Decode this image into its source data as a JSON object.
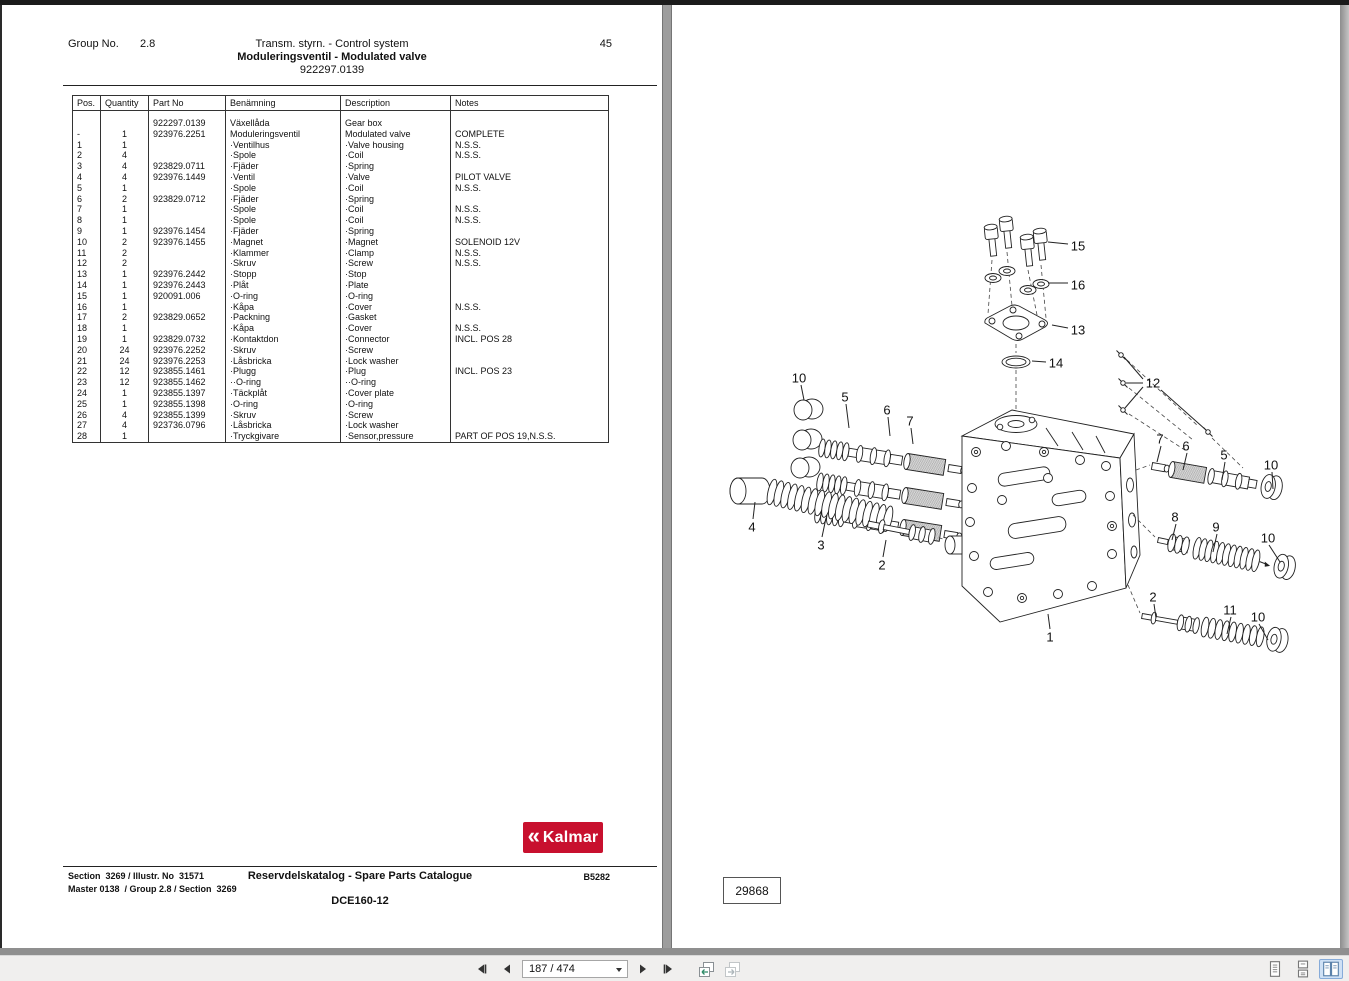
{
  "left_page": {
    "header": {
      "group_label": "Group No.",
      "group_value": "2.8",
      "title1": "Transm. styrn. - Control system",
      "title2": "Moduleringsventil - Modulated valve",
      "part_number": "922297.0139",
      "page_number": "45"
    },
    "table": {
      "columns": [
        "Pos.",
        "Quantity",
        "Part No",
        "Benämning",
        "Description",
        "Notes"
      ],
      "rows": [
        [
          "",
          "",
          "922297.0139",
          "Växellåda",
          "Gear box",
          ""
        ],
        [
          "-",
          "1",
          "923976.2251",
          "Moduleringsventil",
          "Modulated valve",
          "COMPLETE"
        ],
        [
          "1",
          "1",
          "",
          "·Ventilhus",
          "·Valve housing",
          "N.S.S."
        ],
        [
          "2",
          "4",
          "",
          "·Spole",
          "·Coil",
          "N.S.S."
        ],
        [
          "3",
          "4",
          "923829.0711",
          "·Fjäder",
          "·Spring",
          ""
        ],
        [
          "4",
          "4",
          "923976.1449",
          "·Ventil",
          "·Valve",
          "PILOT VALVE"
        ],
        [
          "5",
          "1",
          "",
          "·Spole",
          "·Coil",
          "N.S.S."
        ],
        [
          "6",
          "2",
          "923829.0712",
          "·Fjäder",
          "·Spring",
          ""
        ],
        [
          "7",
          "1",
          "",
          "·Spole",
          "·Coil",
          "N.S.S."
        ],
        [
          "8",
          "1",
          "",
          "·Spole",
          "·Coil",
          "N.S.S."
        ],
        [
          "9",
          "1",
          "923976.1454",
          "·Fjäder",
          "·Spring",
          ""
        ],
        [
          "10",
          "2",
          "923976.1455",
          "·Magnet",
          "·Magnet",
          "SOLENOID 12V"
        ],
        [
          "11",
          "2",
          "",
          "·Klammer",
          "·Clamp",
          "N.S.S."
        ],
        [
          "12",
          "2",
          "",
          "·Skruv",
          "·Screw",
          "N.S.S."
        ],
        [
          "13",
          "1",
          "923976.2442",
          "·Stopp",
          "·Stop",
          ""
        ],
        [
          "14",
          "1",
          "923976.2443",
          "·Plåt",
          "·Plate",
          ""
        ],
        [
          "15",
          "1",
          "920091.006",
          "·O-ring",
          "·O-ring",
          ""
        ],
        [
          "16",
          "1",
          "",
          "·Kåpa",
          "·Cover",
          "N.S.S."
        ],
        [
          "17",
          "2",
          "923829.0652",
          "·Packning",
          "·Gasket",
          ""
        ],
        [
          "18",
          "1",
          "",
          "·Kåpa",
          "·Cover",
          "N.S.S."
        ],
        [
          "19",
          "1",
          "923829.0732",
          "·Kontaktdon",
          "·Connector",
          "INCL. POS 28"
        ],
        [
          "20",
          "24",
          "923976.2252",
          "·Skruv",
          "·Screw",
          ""
        ],
        [
          "21",
          "24",
          "923976.2253",
          "·Låsbricka",
          "·Lock washer",
          ""
        ],
        [
          "22",
          "12",
          "923855.1461",
          "·Plugg",
          "·Plug",
          "INCL. POS 23"
        ],
        [
          "23",
          "12",
          "923855.1462",
          "··O-ring",
          "··O-ring",
          ""
        ],
        [
          "24",
          "1",
          "923855.1397",
          "·Täckplåt",
          "·Cover plate",
          ""
        ],
        [
          "25",
          "1",
          "923855.1398",
          "·O-ring",
          "·O-ring",
          ""
        ],
        [
          "26",
          "4",
          "923855.1399",
          "·Skruv",
          "·Screw",
          ""
        ],
        [
          "27",
          "4",
          "923736.0796",
          "·Låsbricka",
          "·Lock washer",
          ""
        ],
        [
          "28",
          "1",
          "",
          "·Tryckgivare",
          "·Sensor,pressure",
          "PART OF POS 19,N.S.S."
        ]
      ]
    },
    "logo": {
      "mark": "«",
      "word": "Kalmar"
    },
    "footer": {
      "line1_left": "Section  3269 / Illustr. No  31571",
      "line2_left": "Master 0138  / Group 2.8 / Section  3269",
      "center": "Reservdelskatalog - Spare Parts Catalogue",
      "right": "B5282",
      "model": "DCE160-12"
    }
  },
  "right_page": {
    "figure_number": "29868",
    "callouts": [
      {
        "label": "10",
        "tx": 799,
        "ty": 378,
        "lines": [
          [
            801,
            385,
            804,
            400
          ]
        ]
      },
      {
        "label": "5",
        "tx": 845,
        "ty": 397,
        "lines": [
          [
            846,
            404,
            849,
            428
          ]
        ]
      },
      {
        "label": "6",
        "tx": 887,
        "ty": 410,
        "lines": [
          [
            888,
            417,
            890,
            436
          ]
        ]
      },
      {
        "label": "7",
        "tx": 910,
        "ty": 421,
        "lines": [
          [
            911,
            428,
            913,
            444
          ]
        ]
      },
      {
        "label": "4",
        "tx": 752,
        "ty": 527,
        "lines": [
          [
            753,
            519,
            755,
            502
          ]
        ]
      },
      {
        "label": "3",
        "tx": 821,
        "ty": 545,
        "lines": [
          [
            822,
            537,
            826,
            518
          ]
        ]
      },
      {
        "label": "2",
        "tx": 882,
        "ty": 565,
        "lines": [
          [
            883,
            557,
            886,
            540
          ]
        ]
      },
      {
        "label": "15",
        "tx": 1078,
        "ty": 246,
        "lines": [
          [
            1068,
            244,
            1048,
            242
          ]
        ]
      },
      {
        "label": "16",
        "tx": 1078,
        "ty": 285,
        "lines": [
          [
            1068,
            283,
            1048,
            283
          ]
        ]
      },
      {
        "label": "13",
        "tx": 1078,
        "ty": 330,
        "lines": [
          [
            1068,
            328,
            1052,
            325
          ]
        ]
      },
      {
        "label": "14",
        "tx": 1056,
        "ty": 363,
        "lines": [
          [
            1046,
            362,
            1032,
            361
          ]
        ]
      },
      {
        "label": "12",
        "tx": 1153,
        "ty": 383,
        "lines": [
          [
            1143,
            379,
            1124,
            357
          ],
          [
            1143,
            383,
            1126,
            383
          ],
          [
            1143,
            387,
            1125,
            408
          ],
          [
            1161,
            390,
            1206,
            430
          ]
        ]
      },
      {
        "label": "7",
        "tx": 1160,
        "ty": 439,
        "lines": [
          [
            1161,
            446,
            1157,
            462
          ]
        ]
      },
      {
        "label": "6",
        "tx": 1186,
        "ty": 446,
        "lines": [
          [
            1187,
            453,
            1183,
            470
          ]
        ]
      },
      {
        "label": "5",
        "tx": 1224,
        "ty": 455,
        "lines": [
          [
            1225,
            462,
            1222,
            480
          ]
        ]
      },
      {
        "label": "10",
        "tx": 1271,
        "ty": 465,
        "lines": [
          [
            1272,
            472,
            1273,
            489
          ]
        ]
      },
      {
        "label": "8",
        "tx": 1175,
        "ty": 517,
        "lines": [
          [
            1176,
            524,
            1172,
            540
          ]
        ]
      },
      {
        "label": "9",
        "tx": 1216,
        "ty": 527,
        "lines": [
          [
            1217,
            534,
            1213,
            552
          ]
        ]
      },
      {
        "label": "10",
        "tx": 1268,
        "ty": 538,
        "lines": [
          [
            1269,
            545,
            1280,
            562
          ]
        ]
      },
      {
        "label": "2",
        "tx": 1153,
        "ty": 597,
        "lines": [
          [
            1154,
            604,
            1156,
            618
          ]
        ]
      },
      {
        "label": "11",
        "tx": 1230,
        "ty": 610,
        "lines": [
          [
            1231,
            617,
            1227,
            634
          ]
        ]
      },
      {
        "label": "10",
        "tx": 1258,
        "ty": 617,
        "lines": [
          [
            1259,
            624,
            1268,
            640
          ]
        ]
      },
      {
        "label": "1",
        "tx": 1050,
        "ty": 637,
        "lines": [
          [
            1050,
            629,
            1048,
            614
          ]
        ]
      }
    ]
  },
  "toolbar": {
    "page_field": "187 / 474"
  },
  "colors": {
    "kalmar_red": "#c8102e",
    "active_icon_bg": "#cfe1f5"
  }
}
